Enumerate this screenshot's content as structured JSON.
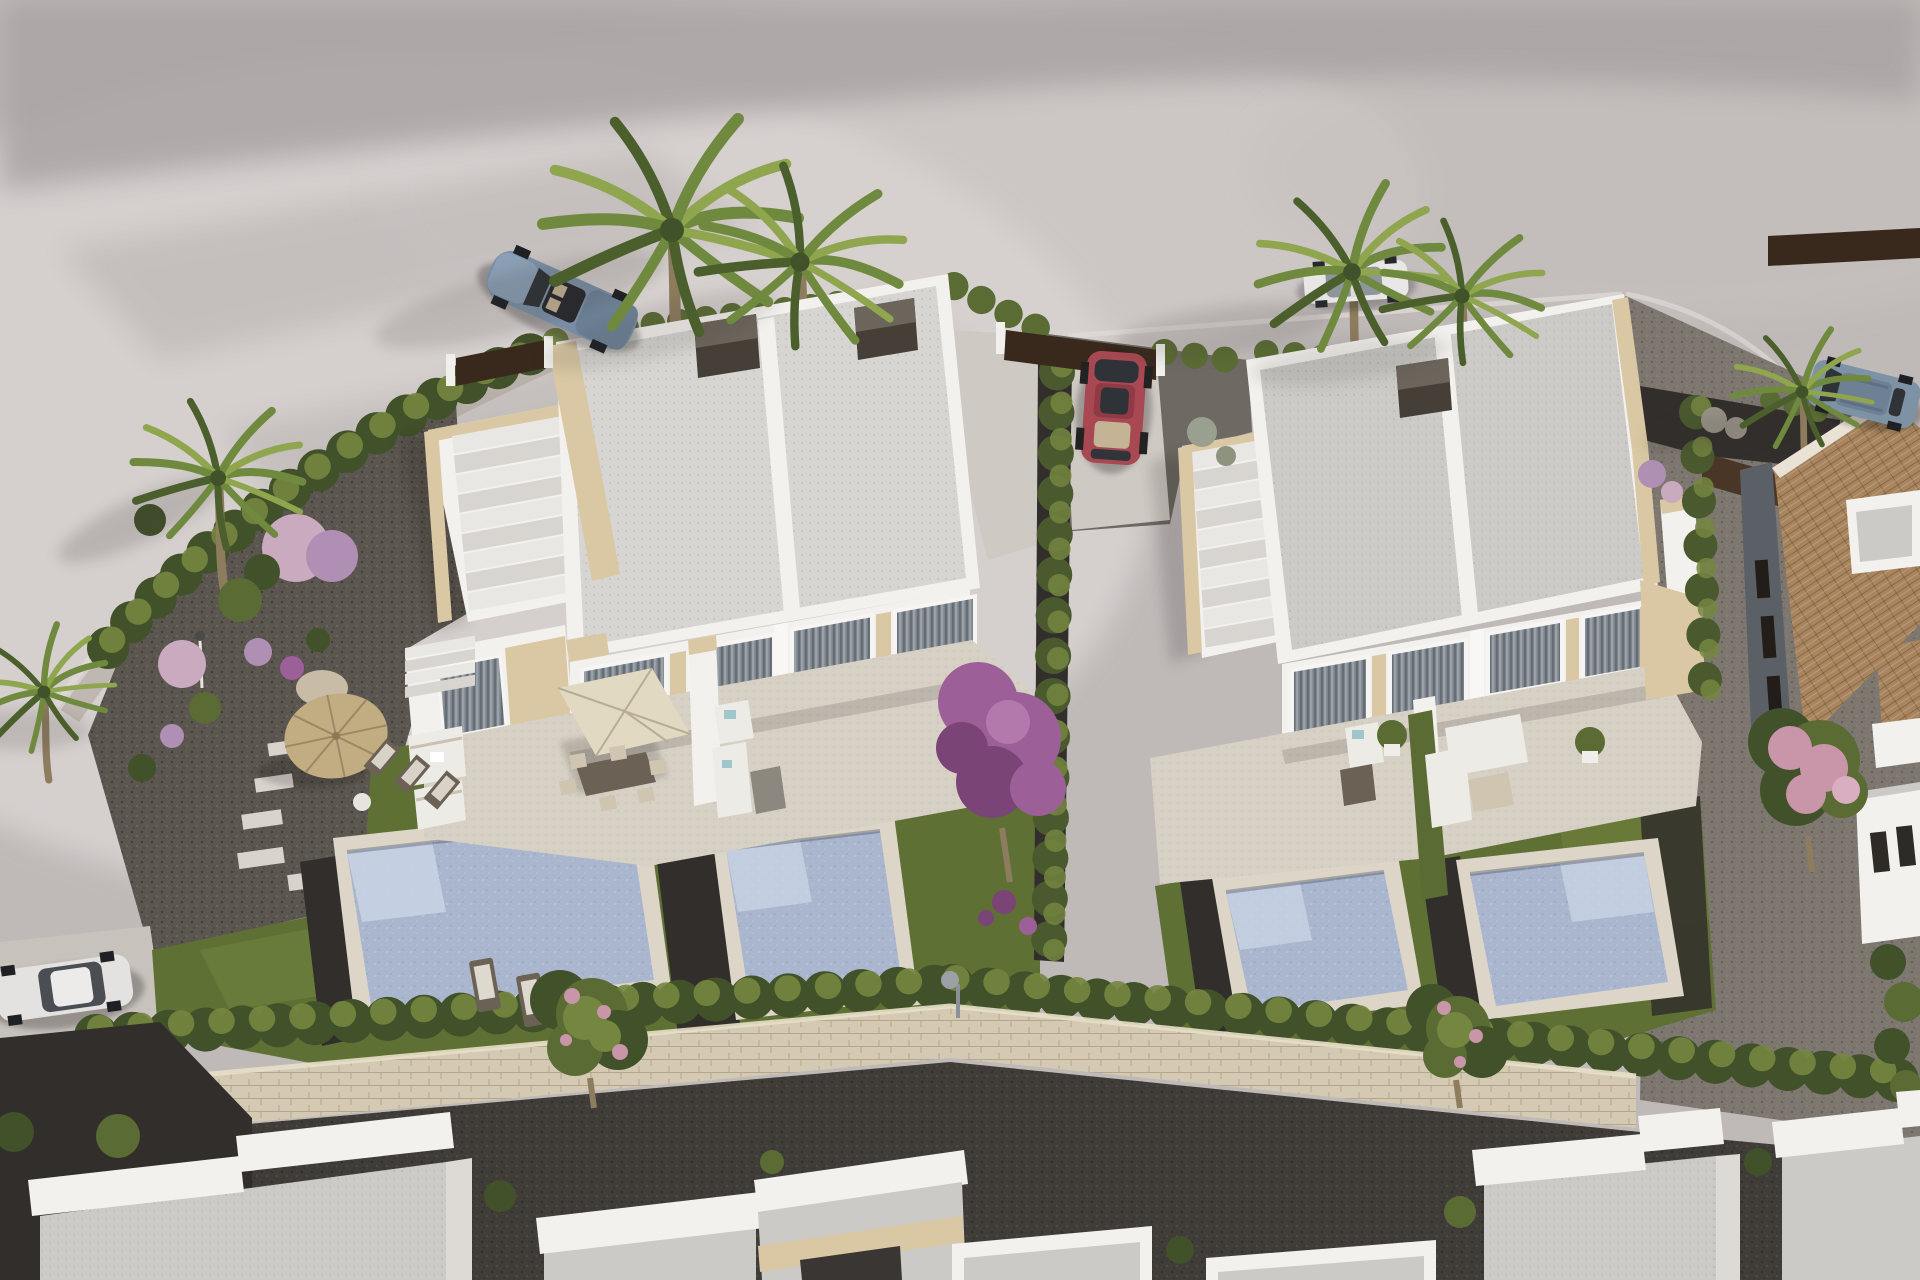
{
  "title": "Aerial 3D architectural rendering of a modern semi-detached villa development",
  "scene": {
    "description": "Bird's-eye render of two white flat-roofed semi-detached villa blocks with private pools and gardens, surrounded by a curved grey road, cypress hedges, palm trees, a stone perimeter wall and neighbouring houses; no text or UI elements are present in the image.",
    "objects": [
      {
        "name": "road-surface",
        "desc": "light grey curved asphalt/pavement wrapping the plot"
      },
      {
        "name": "villa-block-left",
        "desc": "white semi-detached villa, two gravel flat roof panels, travertine accents, roof-terrace with stairs"
      },
      {
        "name": "villa-block-right",
        "desc": "white semi-detached villa, two gravel flat roof panels, travertine accents, roof-terrace with stairs"
      },
      {
        "name": "pools",
        "desc": "four private swimming pools with pale travertine copings",
        "count": 4
      },
      {
        "name": "lawns",
        "desc": "green turf areas around the pools"
      },
      {
        "name": "perimeter-hedge",
        "desc": "rows of clipped green hedging along boundaries"
      },
      {
        "name": "divider-hedge",
        "desc": "tall cypress hedge splitting the two plots, with purple bougainvillea"
      },
      {
        "name": "stone-wall",
        "desc": "low sandstone perimeter wall across the lower part of the site"
      },
      {
        "name": "palm-trees",
        "desc": "fan palms along the street and in the gardens",
        "count": 7
      },
      {
        "name": "flowering-trees",
        "desc": "pink/purple blossoming trees",
        "count": 3
      },
      {
        "name": "car-sports-blue",
        "desc": "blue convertible sports car parked on the top-left road"
      },
      {
        "name": "car-red",
        "desc": "red car parked in the right villa driveway"
      },
      {
        "name": "car-white-estate",
        "desc": "white car on the upper road near twin palms"
      },
      {
        "name": "car-suv-blue",
        "desc": "blue SUV parked at the top-right road edge"
      },
      {
        "name": "car-white-hatch",
        "desc": "white hatchback parked at the lower-left parking pad"
      },
      {
        "name": "straw-parasol",
        "desc": "round straw parasol with deck chairs in the left garden"
      },
      {
        "name": "white-parasol",
        "desc": "square cream parasol over outdoor dining set on the left terrace"
      },
      {
        "name": "terrace-furniture",
        "desc": "white outdoor sofas, day beds, planters on both terraces"
      },
      {
        "name": "sun-loungers",
        "desc": "timber sun loungers on the lawn",
        "count": 2
      },
      {
        "name": "corten-gates",
        "desc": "dark brown entry gate panels along the street boundary"
      },
      {
        "name": "tiled-roof-house",
        "desc": "neighbouring house with tan barrel-tile roof on the right"
      },
      {
        "name": "neighbour-roofs",
        "desc": "white parapet flat roofs of houses along the bottom edge"
      },
      {
        "name": "pool-shower",
        "desc": "small outdoor shower column beside a pool"
      },
      {
        "name": "stepping-stones",
        "desc": "pale stepping stone path in the left garden"
      }
    ],
    "colors": {
      "road_base": "#bfb9b8",
      "road_light": "#d8d2d1",
      "road_band": "#a9a3a3",
      "curb": "#ded8d6",
      "verge": "#a89f94",
      "gravel_garden": "#5b564f",
      "gravel_mid": "#6e6962",
      "gravel_right": "#7d7770",
      "mulch": "#312e2b",
      "alley": "#403c38",
      "drive_pale": "#cfc9c3",
      "parking_pad": "#c8c2bc",
      "lawn": "#5f7034",
      "lawn_light": "#74853f",
      "hedge_dark": "#41512a",
      "hedge_mid": "#5a6c34",
      "hedge_light": "#74863f",
      "cypress": "#4a5a2e",
      "wall_stone": "#d4c9b2",
      "villa_white": "#f3f1ee",
      "villa_shade": "#dddad6",
      "roof_light": "#d6d5d2",
      "roof_mid": "#cbcac7",
      "stone_trim": "#d9c8a3",
      "chimney_dark": "#453f38",
      "chimney_top": "#6b655c",
      "glass": "#7d848c",
      "deck": "#d7d0c4",
      "pool_coping": "#dcd5c8",
      "water": "#a9b6cd",
      "water_light": "#c9d3e5",
      "corten": "#4a3627",
      "gate_dark": "#38291c",
      "tile": "#a8855e",
      "palm_trunk": "#8d7c5e",
      "palm_frond": "#6f8a3e",
      "palm_frond_dark": "#4a5f2c",
      "palm_frond_light": "#8fa54e",
      "bougainvillea": "#9d5f98",
      "bougainvillea_dark": "#7a4476",
      "blossom_pink": "#c995a9",
      "puff_pink": "#c9aabe",
      "puff_lavender": "#b08fb5",
      "parasol_straw": "#c2ad83",
      "parasol_white": "#e2d9c2",
      "furniture_white": "#edebe6",
      "furniture_beige": "#cfc5b0",
      "furniture_dark": "#6b6154",
      "cushion_cyan": "#9fc6cb",
      "car_red": "#a84852",
      "car_sport_blue": "#7b90a8",
      "car_white_estate": "#e8e7e5",
      "car_suv_blue": "#7e92a6",
      "car_white_hatch": "#e3e2e0",
      "car_glass": "#2f3338",
      "seat_tan": "#c4b394",
      "metal": "#8b9196"
    }
  }
}
